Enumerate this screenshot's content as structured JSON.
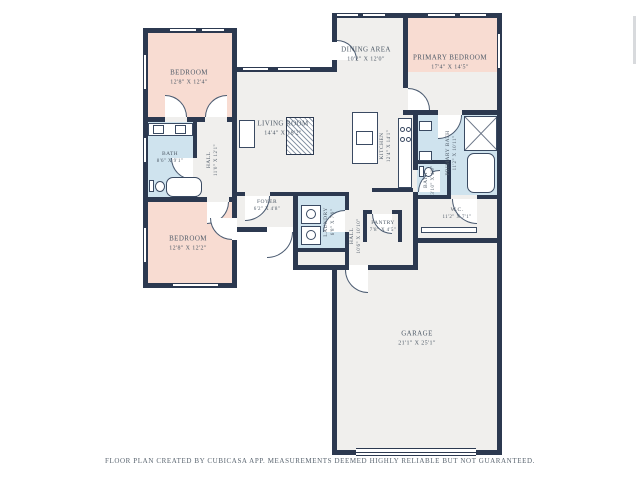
{
  "page": {
    "footer": "FLOOR PLAN CREATED BY CUBICASA APP. MEASUREMENTS DEEMED HIGHLY RELIABLE BUT NOT GUARANTEED."
  },
  "colors": {
    "wall": "#2c3950",
    "bedroom_fill": "#f8dcd2",
    "wet_area_fill": "#cfe3ee",
    "common_fill": "#f0efed",
    "label_text": "#4f5b68"
  },
  "rooms": {
    "bedroom1": {
      "name": "BEDROOM",
      "dims": "12'8\" X 12'4\""
    },
    "bedroom2": {
      "name": "BEDROOM",
      "dims": "12'8\" X 12'2\""
    },
    "primary_bedroom": {
      "name": "PRIMARY BEDROOM",
      "dims": "17'4\" X 14'5\""
    },
    "living_room": {
      "name": "LIVING ROOM",
      "dims": "14'4\" X 18'2\""
    },
    "dining_area": {
      "name": "DINING AREA",
      "dims": "10'2\" X 12'0\""
    },
    "kitchen": {
      "name": "KITCHEN",
      "dims": "12'4\" X 14'1\""
    },
    "bath": {
      "name": "BATH",
      "dims": "8'6\" X 9'1\""
    },
    "hall1": {
      "name": "HALL",
      "dims": "11'0\" X 12'1\""
    },
    "foyer": {
      "name": "FOYER",
      "dims": "6'2\" X 4'8\""
    },
    "laundry": {
      "name": "LAUNDRY",
      "dims": "6'8\" X 7'9\""
    },
    "hall2": {
      "name": "HALL",
      "dims": "10'6\" X 10'10\""
    },
    "pantry": {
      "name": "PANTRY",
      "dims": "7'8\" X 4'5\""
    },
    "wc": {
      "name": "W.C.",
      "dims": "11'2\" X 7'1\""
    },
    "primary_bath": {
      "name": "PRIMARY BATH",
      "dims": "11'2\" X 10'11\""
    },
    "bath2": {
      "name": "BATH",
      "dims": "3'10\" X 4'9\""
    },
    "garage": {
      "name": "GARAGE",
      "dims": "21'1\" X 25'1\""
    }
  }
}
